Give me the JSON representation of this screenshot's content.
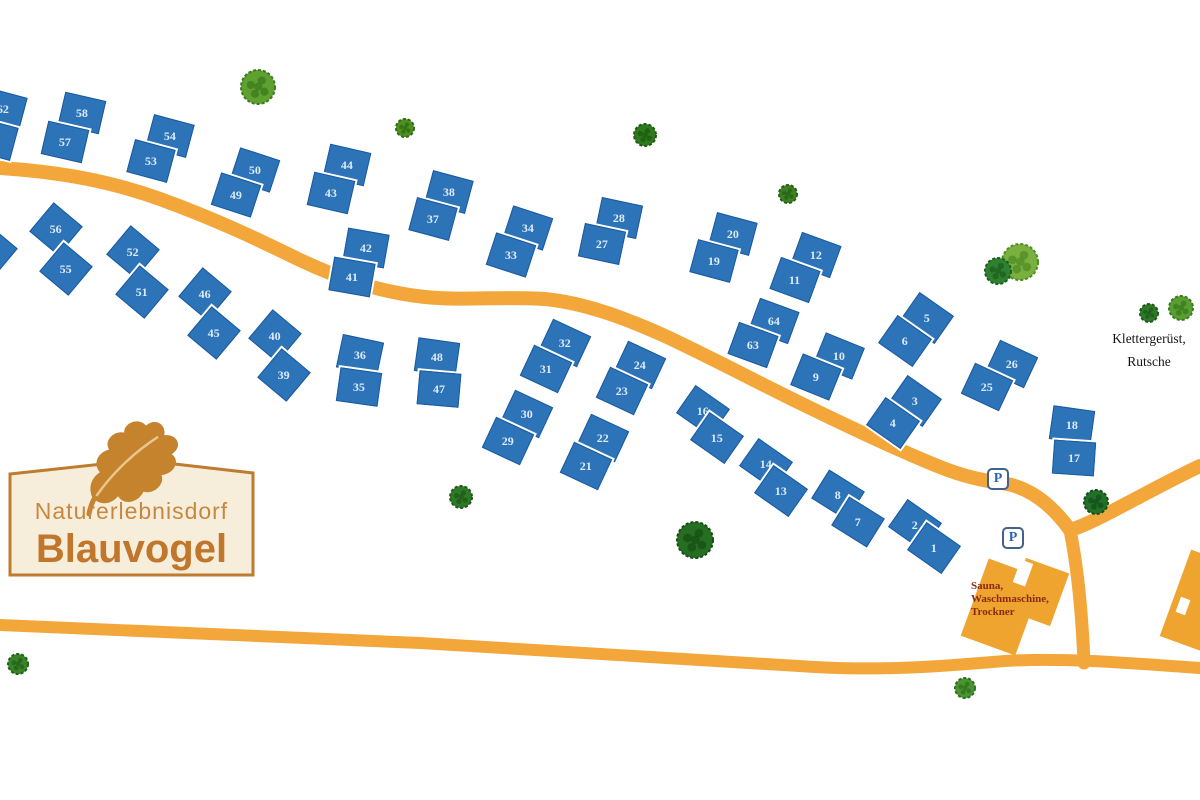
{
  "title": "Naturerlebnisdorf Blauvogel Lageplan",
  "logo": {
    "line1": "Naturerlebnisdorf",
    "line2": "Blauvogel"
  },
  "labels": {
    "playground_line1": "Klettergerüst,",
    "playground_line2": "Rutsche",
    "sauna_line1": "Sauna,",
    "sauna_line2": "Waschmaschine,",
    "sauna_line3": "Trockner",
    "parking_symbol": "P"
  },
  "colors": {
    "background": "#ffffff",
    "road": "#f3a73b",
    "house_fill": "#2d73b7",
    "house_border": "#1a5aa0",
    "house_number": "#dcebf8",
    "building": "#efa430",
    "sign_fill": "#f6eedb",
    "sign_border": "#bf7b2e",
    "logo_text": "#c8873e",
    "sauna_text": "#8a2a10"
  },
  "roads": [
    {
      "name": "main-road",
      "width": 14,
      "path": "M 0 168 C 60 172 110 181 160 199 C 215 219 255 238 300 260 C 340 279 380 292 425 297 C 465 301 505 296 545 299 C 585 303 625 318 665 336 C 710 357 755 381 800 403 C 845 425 895 449 940 467 C 965 477 985 481 1002 483 C 1030 487 1052 505 1070 530"
    },
    {
      "name": "main-road-east",
      "width": 14,
      "path": "M 1070 530 C 1095 523 1145 492 1200 466"
    },
    {
      "name": "sauna-branch-road",
      "width": 13,
      "path": "M 1070 530 C 1077 565 1082 612 1084 663"
    },
    {
      "name": "bottom-road",
      "width": 12,
      "path": "M 0 625 C 140 631 280 637 420 643 C 560 651 700 661 815 667 C 885 671 945 666 1005 661 C 1065 657 1140 664 1200 668"
    }
  ],
  "buildings": [
    {
      "name": "sauna-building-main",
      "x": 1002,
      "y": 607,
      "w": 58,
      "h": 82,
      "r": 20,
      "fill": "building"
    },
    {
      "name": "sauna-building-wing",
      "x": 1038,
      "y": 592,
      "w": 46,
      "h": 56,
      "r": 20,
      "fill": "building"
    },
    {
      "name": "sauna-building-notch",
      "x": 1023,
      "y": 573,
      "w": 13,
      "h": 24,
      "r": 20,
      "fill": "bg"
    },
    {
      "name": "east-edge-building",
      "x": 1198,
      "y": 601,
      "w": 48,
      "h": 92,
      "r": 20,
      "fill": "building"
    },
    {
      "name": "east-edge-building-notch",
      "x": 1183,
      "y": 606,
      "w": 10,
      "h": 16,
      "r": 20,
      "fill": "bg"
    }
  ],
  "parking": [
    {
      "x": 998,
      "y": 479
    },
    {
      "x": 1013,
      "y": 538
    }
  ],
  "trees": [
    {
      "x": 258,
      "y": 87,
      "r": 17,
      "c": "#5fa130",
      "d": "#3c7a1d"
    },
    {
      "x": 405,
      "y": 128,
      "r": 9,
      "c": "#4f9022",
      "d": "#2f6a14"
    },
    {
      "x": 645,
      "y": 135,
      "r": 11,
      "c": "#2f7a1e",
      "d": "#1d5a10"
    },
    {
      "x": 788,
      "y": 194,
      "r": 9,
      "c": "#3c8224",
      "d": "#255f12"
    },
    {
      "x": 1020,
      "y": 262,
      "r": 18,
      "c": "#79b03f",
      "d": "#4f8c26"
    },
    {
      "x": 998,
      "y": 271,
      "r": 13,
      "c": "#2f8030",
      "d": "#1c5f1e"
    },
    {
      "x": 1181,
      "y": 308,
      "r": 12,
      "c": "#5a9e33",
      "d": "#3a7a1e"
    },
    {
      "x": 1149,
      "y": 313,
      "r": 9,
      "c": "#2f7a28",
      "d": "#1d5a18"
    },
    {
      "x": 461,
      "y": 497,
      "r": 11,
      "c": "#2f7a28",
      "d": "#1d5a18"
    },
    {
      "x": 695,
      "y": 540,
      "r": 18,
      "c": "#256e22",
      "d": "#154f14"
    },
    {
      "x": 1096,
      "y": 502,
      "r": 12,
      "c": "#237029",
      "d": "#124f18"
    },
    {
      "x": 18,
      "y": 664,
      "r": 10,
      "c": "#3a8428",
      "d": "#236018"
    },
    {
      "x": 965,
      "y": 688,
      "r": 10,
      "c": "#4c9432",
      "d": "#2f701e"
    }
  ],
  "house_sizes": {
    "a": [
      42,
      34
    ],
    "b": [
      38,
      38
    ]
  },
  "houses": [
    [
      "62",
      3,
      109,
      15,
      "a"
    ],
    [
      "",
      -6,
      139,
      15,
      "a"
    ],
    [
      "58",
      82,
      113,
      13,
      "a"
    ],
    [
      "57",
      65,
      142,
      13,
      "a"
    ],
    [
      "54",
      170,
      136,
      15,
      "a"
    ],
    [
      "53",
      151,
      161,
      15,
      "a"
    ],
    [
      "50",
      255,
      170,
      18,
      "a"
    ],
    [
      "49",
      236,
      195,
      18,
      "a"
    ],
    [
      "44",
      347,
      165,
      13,
      "a"
    ],
    [
      "43",
      331,
      193,
      13,
      "a"
    ],
    [
      "38",
      449,
      192,
      15,
      "a"
    ],
    [
      "37",
      433,
      219,
      15,
      "a"
    ],
    [
      "34",
      528,
      228,
      18,
      "a"
    ],
    [
      "33",
      511,
      255,
      18,
      "a"
    ],
    [
      "28",
      619,
      218,
      12,
      "a"
    ],
    [
      "27",
      602,
      244,
      12,
      "a"
    ],
    [
      "20",
      733,
      234,
      15,
      "a"
    ],
    [
      "19",
      714,
      261,
      15,
      "a"
    ],
    [
      "12",
      816,
      255,
      20,
      "a"
    ],
    [
      "11",
      795,
      280,
      20,
      "a"
    ],
    [
      "56",
      56,
      229,
      40,
      "b"
    ],
    [
      "55",
      66,
      269,
      40,
      "b"
    ],
    [
      "",
      -9,
      251,
      40,
      "b"
    ],
    [
      "52",
      133,
      252,
      40,
      "b"
    ],
    [
      "51",
      142,
      292,
      40,
      "b"
    ],
    [
      "46",
      205,
      294,
      40,
      "b"
    ],
    [
      "45",
      214,
      333,
      40,
      "b"
    ],
    [
      "42",
      366,
      248,
      10,
      "a"
    ],
    [
      "41",
      352,
      277,
      10,
      "a"
    ],
    [
      "40",
      275,
      336,
      40,
      "b"
    ],
    [
      "39",
      284,
      375,
      40,
      "b"
    ],
    [
      "36",
      360,
      355,
      12,
      "a"
    ],
    [
      "35",
      359,
      387,
      8,
      "a"
    ],
    [
      "48",
      437,
      357,
      8,
      "a"
    ],
    [
      "47",
      439,
      389,
      5,
      "a"
    ],
    [
      "32",
      565,
      343,
      25,
      "a"
    ],
    [
      "31",
      546,
      369,
      25,
      "a"
    ],
    [
      "24",
      640,
      365,
      25,
      "a"
    ],
    [
      "23",
      622,
      391,
      25,
      "a"
    ],
    [
      "64",
      774,
      321,
      20,
      "a"
    ],
    [
      "63",
      753,
      345,
      20,
      "a"
    ],
    [
      "10",
      839,
      356,
      22,
      "a"
    ],
    [
      "9",
      816,
      377,
      22,
      "a"
    ],
    [
      "5",
      927,
      318,
      35,
      "a"
    ],
    [
      "6",
      905,
      341,
      35,
      "a"
    ],
    [
      "26",
      1012,
      364,
      25,
      "a"
    ],
    [
      "25",
      987,
      387,
      25,
      "a"
    ],
    [
      "3",
      915,
      401,
      35,
      "a"
    ],
    [
      "4",
      893,
      423,
      35,
      "a"
    ],
    [
      "30",
      527,
      414,
      25,
      "a"
    ],
    [
      "29",
      508,
      441,
      25,
      "a"
    ],
    [
      "22",
      603,
      438,
      25,
      "a"
    ],
    [
      "21",
      586,
      466,
      25,
      "a"
    ],
    [
      "18",
      1072,
      425,
      8,
      "a"
    ],
    [
      "17",
      1074,
      458,
      4,
      "a"
    ],
    [
      "16",
      703,
      411,
      35,
      "a"
    ],
    [
      "15",
      717,
      438,
      35,
      "a"
    ],
    [
      "14",
      766,
      464,
      35,
      "a"
    ],
    [
      "13",
      781,
      491,
      35,
      "a"
    ],
    [
      "8",
      838,
      495,
      32,
      "a"
    ],
    [
      "7",
      858,
      522,
      32,
      "a"
    ],
    [
      "2",
      915,
      525,
      35,
      "a"
    ],
    [
      "1",
      934,
      548,
      35,
      "a"
    ]
  ]
}
